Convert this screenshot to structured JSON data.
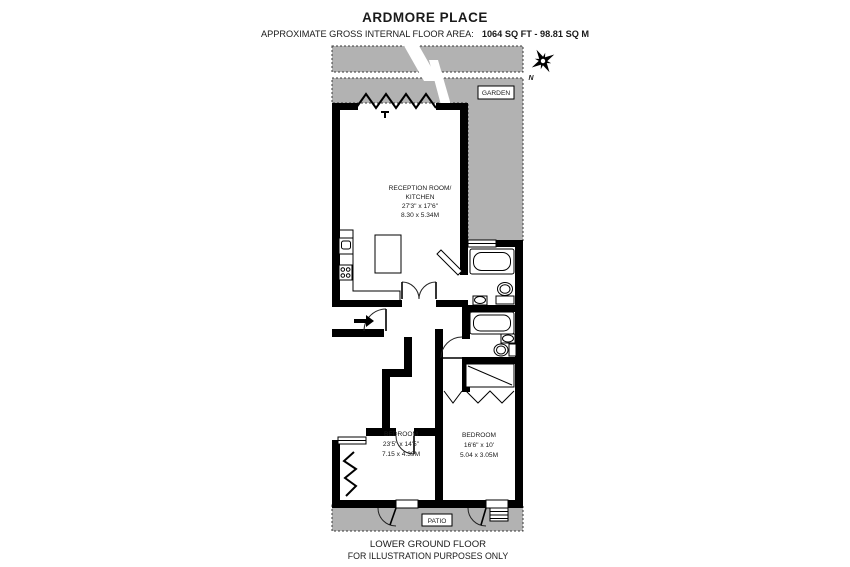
{
  "header": {
    "title": "ARDMORE PLACE",
    "area_label": "APPROXIMATE GROSS INTERNAL FLOOR AREA:",
    "area_value": "1064 SQ FT - 98.81 SQ M"
  },
  "plan": {
    "colors": {
      "garden_fill": "#b2b2b2",
      "wall": "#000000"
    },
    "garden": {
      "label": "GARDEN"
    },
    "patio": {
      "label": "PATIO"
    },
    "compass": {
      "north_label": "N"
    },
    "reception": {
      "line1": "RECEPTION ROOM/",
      "line2": "KITCHEN",
      "dims_imperial": "27'3\" x 17'6\"",
      "dims_metric": "8.30 x 5.34M"
    },
    "bedroom1": {
      "name": "BEDROOM",
      "dims_imperial": "23'5\" x 14'5\"",
      "dims_metric": "7.15 x 4.39M"
    },
    "bedroom2": {
      "name": "BEDROOM",
      "dims_imperial": "16'6\" x 10'",
      "dims_metric": "5.04 x 3.05M"
    }
  },
  "footer": {
    "line1": "LOWER GROUND FLOOR",
    "line2": "FOR ILLUSTRATION PURPOSES ONLY"
  }
}
